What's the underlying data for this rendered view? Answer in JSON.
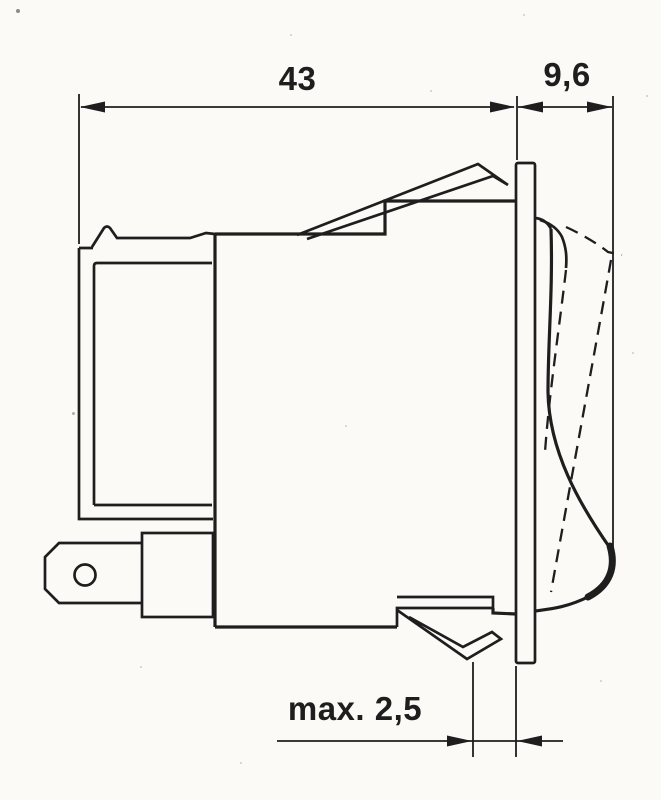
{
  "colors": {
    "paper": "#fbfaf7",
    "ink": "#1e1e1e"
  },
  "drawing": {
    "dimensions": {
      "overall_length": {
        "label": "43"
      },
      "bezel_depth": {
        "label": "9,6"
      },
      "panel_thickness": {
        "label": "max. 2,5"
      }
    }
  }
}
